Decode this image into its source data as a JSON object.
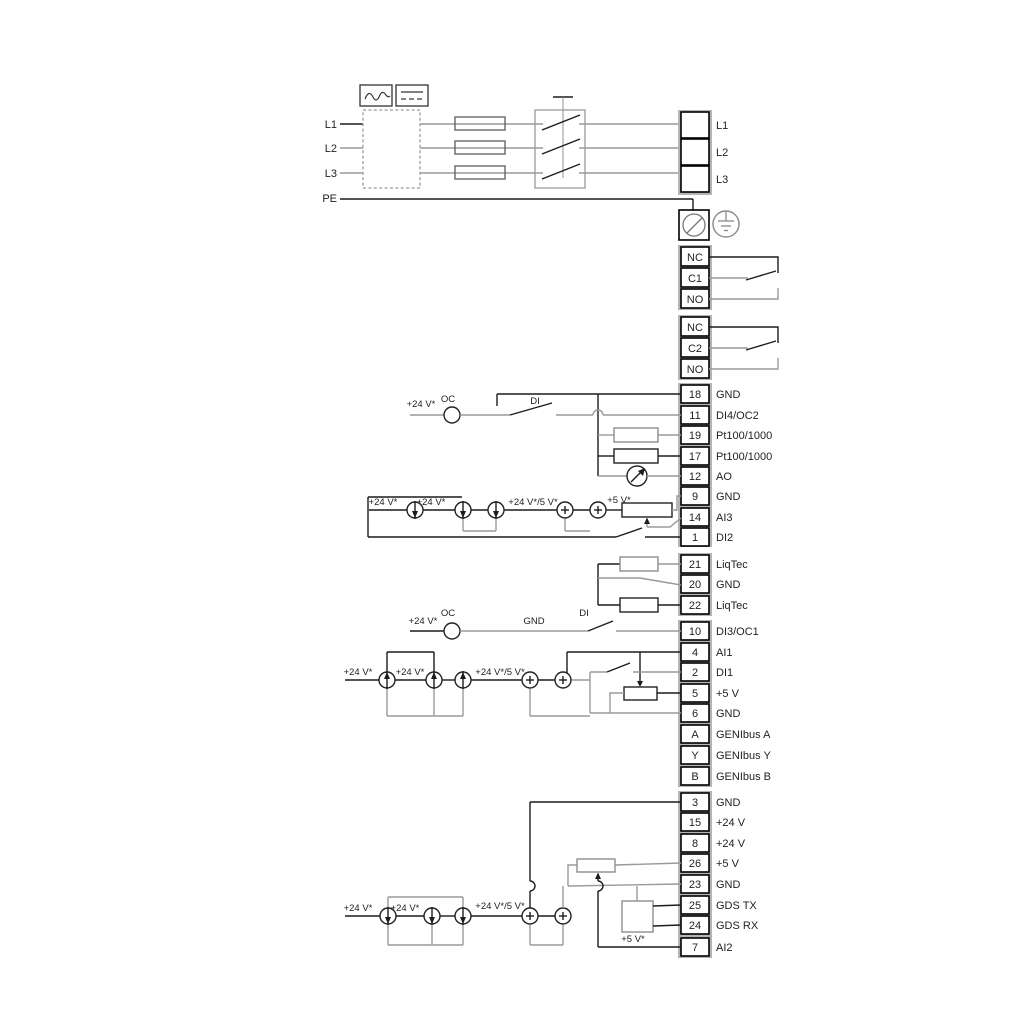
{
  "diagram": {
    "power": {
      "input_labels": [
        "L1",
        "L2",
        "L3",
        "PE"
      ],
      "output_block": [
        "L1",
        "L2",
        "L3"
      ]
    },
    "relay1": {
      "rows": [
        "NC",
        "C1",
        "NO"
      ]
    },
    "relay2": {
      "rows": [
        "NC",
        "C2",
        "NO"
      ]
    },
    "io1": [
      {
        "id": "18",
        "label": "GND"
      },
      {
        "id": "11",
        "label": "DI4/OC2"
      },
      {
        "id": "19",
        "label": "Pt100/1000"
      },
      {
        "id": "17",
        "label": "Pt100/1000"
      },
      {
        "id": "12",
        "label": "AO"
      },
      {
        "id": "9",
        "label": "GND"
      },
      {
        "id": "14",
        "label": "AI3"
      },
      {
        "id": "1",
        "label": "DI2"
      }
    ],
    "liqtec": [
      {
        "id": "21",
        "label": "LiqTec"
      },
      {
        "id": "20",
        "label": "GND"
      },
      {
        "id": "22",
        "label": "LiqTec"
      }
    ],
    "io2": [
      {
        "id": "10",
        "label": "DI3/OC1"
      },
      {
        "id": "4",
        "label": "AI1"
      },
      {
        "id": "2",
        "label": "DI1"
      },
      {
        "id": "5",
        "label": "+5 V"
      },
      {
        "id": "6",
        "label": "GND"
      },
      {
        "id": "A",
        "label": "GENIbus A"
      },
      {
        "id": "Y",
        "label": "GENIbus Y"
      },
      {
        "id": "B",
        "label": "GENIbus B"
      }
    ],
    "io3": [
      {
        "id": "3",
        "label": "GND"
      },
      {
        "id": "15",
        "label": "+24 V"
      },
      {
        "id": "8",
        "label": "+24 V"
      },
      {
        "id": "26",
        "label": "+5 V"
      },
      {
        "id": "23",
        "label": "GND"
      },
      {
        "id": "25",
        "label": "GDS TX"
      },
      {
        "id": "24",
        "label": "GDS RX"
      },
      {
        "id": "7",
        "label": "AI2"
      }
    ],
    "ann": {
      "plus24": "+24 V*",
      "oc": "OC",
      "di": "DI",
      "gnd": "GND",
      "plus24or5": "+24 V*/5 V*",
      "plus5": "+5 V*"
    },
    "colors": {
      "wire_gray": "#9a9a9a",
      "wire_black": "#1c1c1c",
      "background": "#ffffff"
    }
  }
}
